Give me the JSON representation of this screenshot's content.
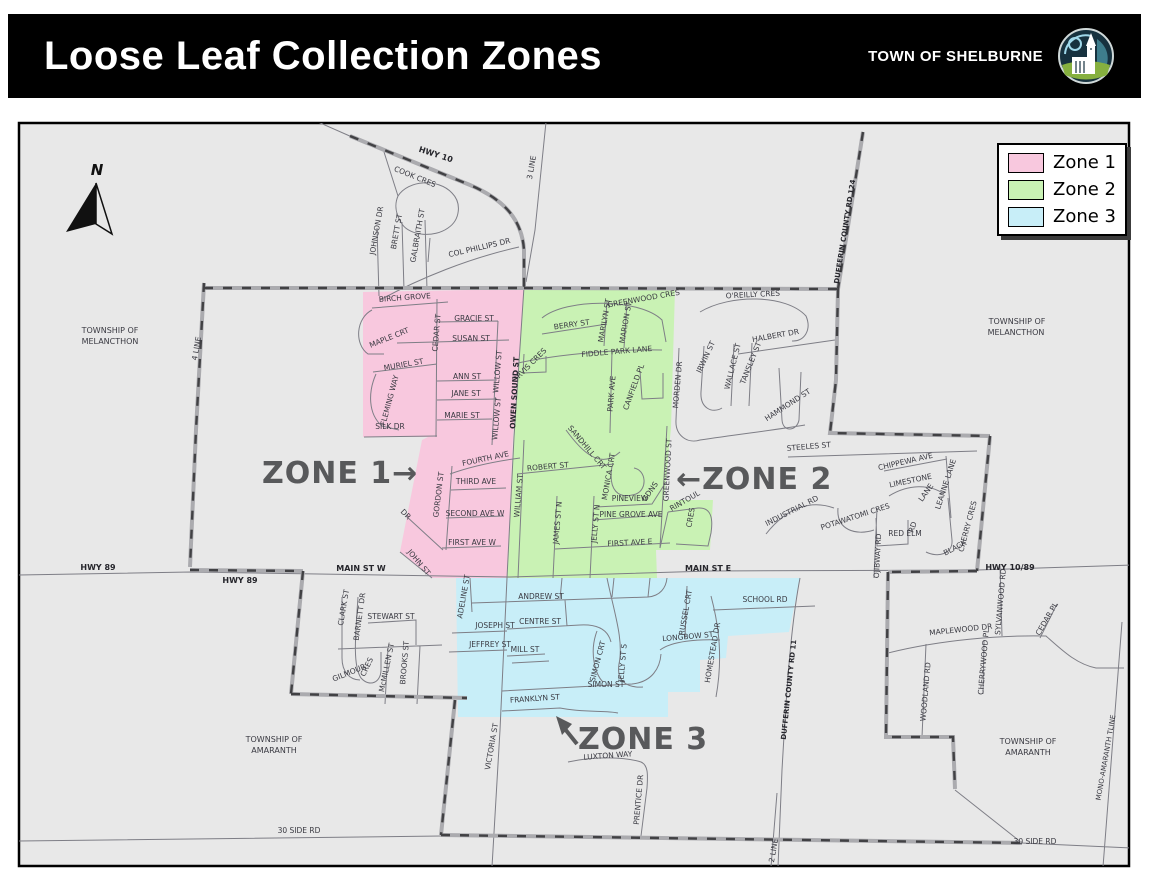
{
  "header": {
    "title": "Loose Leaf Collection Zones",
    "org": "TOWN OF SHELBURNE"
  },
  "legend": {
    "items": [
      {
        "label": "Zone 1",
        "color": "#f8c8de"
      },
      {
        "label": "Zone 2",
        "color": "#c9f2b4"
      },
      {
        "label": "Zone 3",
        "color": "#c8eef8"
      }
    ]
  },
  "map": {
    "background": "#e8e8e8",
    "north_label": "N",
    "zone_label_color": "#58595b",
    "zones": [
      {
        "name": "Zone 1",
        "color": "#f8c8de",
        "points": "363,292 524,289 513,437 507,578 431,578 400,552 407,516 422,440 428,437 363,437"
      },
      {
        "name": "Zone 2",
        "color": "#c9f2b4",
        "points": "524,289 675,289 671,428 664,500 713,500 710,550 656,550 657,578 507,578 514,437"
      },
      {
        "name": "Zone 3",
        "color": "#c8eef8",
        "points": "456,578 800,578 789,632 728,636 726,658 700,660 700,692 668,692 668,717 458,717"
      }
    ],
    "zone_labels": [
      {
        "text": "ZONE 1→",
        "x": 262,
        "y": 483
      },
      {
        "text": "←ZONE 2",
        "x": 676,
        "y": 489
      },
      {
        "text": "ZONE 3",
        "x": 578,
        "y": 749
      }
    ],
    "labels": [
      {
        "t": "HWY 10",
        "x": 435,
        "y": 157,
        "r": 18,
        "b": 1,
        "s": 8
      },
      {
        "t": "COOK CRES",
        "x": 414,
        "y": 179,
        "r": 22
      },
      {
        "t": "3 LINE",
        "x": 534,
        "y": 168,
        "r": -80
      },
      {
        "t": "JOHNSON DR",
        "x": 379,
        "y": 231,
        "r": -80
      },
      {
        "t": "BRETT ST",
        "x": 399,
        "y": 232,
        "r": -80
      },
      {
        "t": "GALBRAITH ST",
        "x": 420,
        "y": 236,
        "r": -80
      },
      {
        "t": "COL PHILLIPS DR",
        "x": 480,
        "y": 250,
        "r": -13
      },
      {
        "t": "TOWNSHIP OF",
        "x": 110,
        "y": 333,
        "s": 8
      },
      {
        "t": "MELANCTHON",
        "x": 110,
        "y": 344,
        "s": 8
      },
      {
        "t": "4 LINE",
        "x": 199,
        "y": 349,
        "r": -80
      },
      {
        "t": "BIRCH GROVE",
        "x": 405,
        "y": 300,
        "r": -4
      },
      {
        "t": "MAPLE CRT",
        "x": 390,
        "y": 340,
        "r": -22
      },
      {
        "t": "CEDAR ST",
        "x": 439,
        "y": 333,
        "r": -85
      },
      {
        "t": "GRACIE ST",
        "x": 474,
        "y": 321
      },
      {
        "t": "SUSAN ST",
        "x": 471,
        "y": 341
      },
      {
        "t": "MURIEL ST",
        "x": 404,
        "y": 367,
        "r": -10
      },
      {
        "t": "FLEMING WAY",
        "x": 392,
        "y": 401,
        "r": -75
      },
      {
        "t": "ANN ST",
        "x": 467,
        "y": 379
      },
      {
        "t": "JANE ST",
        "x": 466,
        "y": 396
      },
      {
        "t": "MARIE ST",
        "x": 462,
        "y": 418
      },
      {
        "t": "WILLOW ST",
        "x": 500,
        "y": 372,
        "r": -85
      },
      {
        "t": "WILLOW ST",
        "x": 499,
        "y": 419,
        "r": -85
      },
      {
        "t": "SILK DR",
        "x": 390,
        "y": 429
      },
      {
        "t": "OWEN SOUND ST",
        "x": 517,
        "y": 393,
        "r": -87,
        "b": 1
      },
      {
        "t": "FOURTH AVE",
        "x": 486,
        "y": 461,
        "r": -12
      },
      {
        "t": "GORDON ST",
        "x": 441,
        "y": 495,
        "r": -83
      },
      {
        "t": "THIRD AVE",
        "x": 476,
        "y": 484
      },
      {
        "t": "SECOND AVE W",
        "x": 475,
        "y": 516
      },
      {
        "t": "FIRST AVE W",
        "x": 472,
        "y": 545
      },
      {
        "t": "DR",
        "x": 404,
        "y": 516,
        "r": 45
      },
      {
        "t": "JOHN ST",
        "x": 417,
        "y": 564,
        "r": 50
      },
      {
        "t": "HWY 89",
        "x": 98,
        "y": 570,
        "b": 1,
        "s": 8
      },
      {
        "t": "HWY 89",
        "x": 240,
        "y": 583,
        "b": 1,
        "s": 8
      },
      {
        "t": "MAIN ST W",
        "x": 361,
        "y": 571,
        "b": 1,
        "s": 8
      },
      {
        "t": "GREENWOOD CRES",
        "x": 644,
        "y": 301,
        "r": -10
      },
      {
        "t": "BERRY ST",
        "x": 572,
        "y": 327,
        "r": -8
      },
      {
        "t": "MARILYN ST",
        "x": 607,
        "y": 321,
        "r": -80
      },
      {
        "t": "MARION ST",
        "x": 628,
        "y": 323,
        "r": -80
      },
      {
        "t": "FIDDLE PARK LANE",
        "x": 617,
        "y": 354,
        "r": -5
      },
      {
        "t": "ORVIS CRES",
        "x": 531,
        "y": 367,
        "r": -45
      },
      {
        "t": "PARK AVE",
        "x": 614,
        "y": 394,
        "r": -85
      },
      {
        "t": "CANFIELD PL",
        "x": 636,
        "y": 388,
        "r": -70
      },
      {
        "t": "SANDHILL CRT",
        "x": 585,
        "y": 449,
        "r": 50
      },
      {
        "t": "ROBERT ST",
        "x": 548,
        "y": 469,
        "r": -5
      },
      {
        "t": "MONICA CRT",
        "x": 611,
        "y": 477,
        "r": -80
      },
      {
        "t": "PINEVIEW",
        "x": 630,
        "y": 501
      },
      {
        "t": "GDNS",
        "x": 652,
        "y": 493,
        "r": -55
      },
      {
        "t": "GREENWOOD ST",
        "x": 670,
        "y": 470,
        "r": -87
      },
      {
        "t": "WILLIAM ST",
        "x": 521,
        "y": 496,
        "r": -85
      },
      {
        "t": "JAMES ST N",
        "x": 560,
        "y": 523,
        "r": -85
      },
      {
        "t": "JELLY ST N",
        "x": 598,
        "y": 524,
        "r": -85
      },
      {
        "t": "PINE GROVE AVE",
        "x": 631,
        "y": 517
      },
      {
        "t": "FIRST AVE E",
        "x": 630,
        "y": 545,
        "r": -3
      },
      {
        "t": "RINTOUL",
        "x": 686,
        "y": 503,
        "r": -30
      },
      {
        "t": "CRES",
        "x": 693,
        "y": 518,
        "r": -80
      },
      {
        "t": "MAIN ST E",
        "x": 708,
        "y": 571,
        "b": 1,
        "s": 8
      },
      {
        "t": "O'REILLY CRES",
        "x": 753,
        "y": 297,
        "r": -3
      },
      {
        "t": "IRWIN ST",
        "x": 708,
        "y": 358,
        "r": -65
      },
      {
        "t": "WALLACE ST",
        "x": 735,
        "y": 367,
        "r": -76
      },
      {
        "t": "TANSLEY ST",
        "x": 753,
        "y": 364,
        "r": -68
      },
      {
        "t": "HALBERT DR",
        "x": 776,
        "y": 338,
        "r": -10
      },
      {
        "t": "MORDEN DR",
        "x": 680,
        "y": 385,
        "r": -85
      },
      {
        "t": "HAMMOND ST",
        "x": 789,
        "y": 407,
        "r": -33
      },
      {
        "t": "DUFFERIN COUNTY RD 124",
        "x": 847,
        "y": 232,
        "r": -81,
        "b": 1,
        "s": 7
      },
      {
        "t": "TOWNSHIP OF",
        "x": 1017,
        "y": 324,
        "s": 8
      },
      {
        "t": "MELANCTHON",
        "x": 1016,
        "y": 335,
        "s": 8
      },
      {
        "t": "STEELES ST",
        "x": 809,
        "y": 449,
        "r": -5
      },
      {
        "t": "CHIPPEWA AVE",
        "x": 906,
        "y": 464,
        "r": -13
      },
      {
        "t": "LIMESTONE",
        "x": 911,
        "y": 483,
        "r": -12
      },
      {
        "t": "LANE",
        "x": 928,
        "y": 494,
        "r": -55
      },
      {
        "t": "LEANNE LANE",
        "x": 948,
        "y": 485,
        "r": -72
      },
      {
        "t": "POTAWATOMI CRES",
        "x": 856,
        "y": 519,
        "r": -18
      },
      {
        "t": "RED ELM",
        "x": 905,
        "y": 536
      },
      {
        "t": "RD",
        "x": 915,
        "y": 528,
        "r": -70
      },
      {
        "t": "BLACK",
        "x": 956,
        "y": 550,
        "r": -28
      },
      {
        "t": "CHERRY CRES",
        "x": 970,
        "y": 527,
        "r": -75
      },
      {
        "t": "OJIBWAY RD",
        "x": 880,
        "y": 556,
        "r": -87
      },
      {
        "t": "INDUSTRIAL RD",
        "x": 793,
        "y": 513,
        "r": -27
      },
      {
        "t": "HWY 10/89",
        "x": 1010,
        "y": 570,
        "b": 1,
        "s": 8
      },
      {
        "t": "ADELINE ST",
        "x": 466,
        "y": 597,
        "r": -80
      },
      {
        "t": "ANDREW ST",
        "x": 541,
        "y": 599
      },
      {
        "t": "CENTRE ST",
        "x": 540,
        "y": 624
      },
      {
        "t": "JOSEPH ST",
        "x": 495,
        "y": 628
      },
      {
        "t": "JEFFREY ST",
        "x": 490,
        "y": 647
      },
      {
        "t": "MILL ST",
        "x": 525,
        "y": 652
      },
      {
        "t": "SIMON CRT",
        "x": 600,
        "y": 662,
        "r": -75
      },
      {
        "t": "JELLY ST S",
        "x": 625,
        "y": 663,
        "r": -85
      },
      {
        "t": "SIMON ST",
        "x": 606,
        "y": 687
      },
      {
        "t": "FRANKLYN ST",
        "x": 535,
        "y": 701,
        "r": -4
      },
      {
        "t": "RUSSEL CRT",
        "x": 688,
        "y": 613,
        "r": -80
      },
      {
        "t": "LONGBOW ST",
        "x": 688,
        "y": 639,
        "r": -5
      },
      {
        "t": "HOMESTEAD DR",
        "x": 715,
        "y": 653,
        "r": -80
      },
      {
        "t": "SCHOOL RD",
        "x": 765,
        "y": 602
      },
      {
        "t": "VICTORIA ST",
        "x": 494,
        "y": 747,
        "r": -80
      },
      {
        "t": "LUXTON WAY",
        "x": 608,
        "y": 758,
        "r": -4
      },
      {
        "t": "PRENTICE DR",
        "x": 641,
        "y": 800,
        "r": -85
      },
      {
        "t": "DUFFERIN COUNTY RD 11",
        "x": 791,
        "y": 690,
        "r": -84,
        "b": 1,
        "s": 7
      },
      {
        "t": "2 LINE",
        "x": 776,
        "y": 851,
        "r": -80
      },
      {
        "t": "TOWNSHIP OF",
        "x": 274,
        "y": 742,
        "s": 8
      },
      {
        "t": "AMARANTH",
        "x": 274,
        "y": 753,
        "s": 8
      },
      {
        "t": "30 SIDE RD",
        "x": 299,
        "y": 833
      },
      {
        "t": "CLARK ST",
        "x": 346,
        "y": 608,
        "r": -80
      },
      {
        "t": "BARNETT DR",
        "x": 362,
        "y": 617,
        "r": -82
      },
      {
        "t": "STEWART ST",
        "x": 391,
        "y": 619
      },
      {
        "t": "GILMOUR",
        "x": 350,
        "y": 675,
        "r": -22
      },
      {
        "t": "CRES",
        "x": 369,
        "y": 668,
        "r": -65
      },
      {
        "t": "McMILLEN ST",
        "x": 389,
        "y": 668,
        "r": -78
      },
      {
        "t": "BROOKS ST",
        "x": 407,
        "y": 663,
        "r": -85
      },
      {
        "t": "MAPLEWOOD DR",
        "x": 961,
        "y": 632,
        "r": -6
      },
      {
        "t": "SYLVANWOOD RD",
        "x": 1003,
        "y": 602,
        "r": -85
      },
      {
        "t": "CHERRYWOOD PL",
        "x": 986,
        "y": 662,
        "r": -85
      },
      {
        "t": "CEDAR PL",
        "x": 1049,
        "y": 620,
        "r": -60
      },
      {
        "t": "WOODLAND RD",
        "x": 928,
        "y": 692,
        "r": -85
      },
      {
        "t": "TOWNSHIP OF",
        "x": 1028,
        "y": 744,
        "s": 8
      },
      {
        "t": "AMARANTH",
        "x": 1028,
        "y": 755,
        "s": 8
      },
      {
        "t": "MONO-AMARANTH TLINE",
        "x": 1108,
        "y": 758,
        "r": -80,
        "s": 7
      },
      {
        "t": "30 SIDE RD",
        "x": 1035,
        "y": 844
      }
    ]
  }
}
